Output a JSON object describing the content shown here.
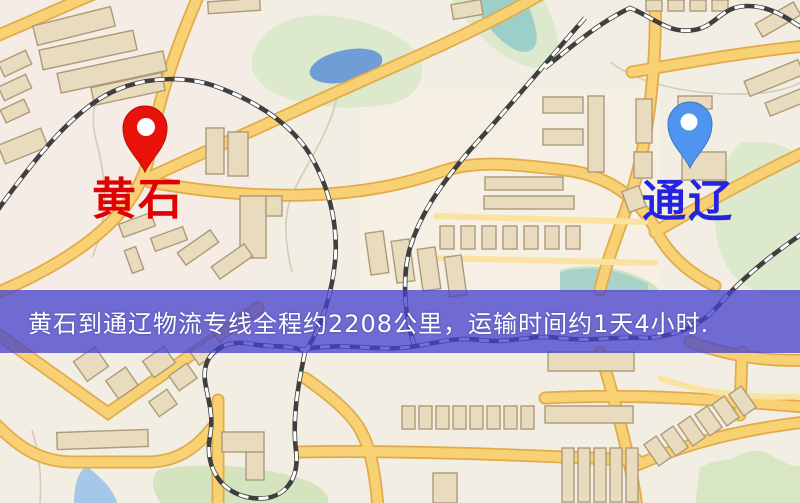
{
  "banner": {
    "text": "黄石到通辽物流专线全程约2208公里，运输时间约1天4小时.",
    "background_color": "#4642cd",
    "text_color": "#ffffff"
  },
  "route": {
    "origin": "黄石",
    "destination": "通辽",
    "distance_km": "2208",
    "duration": "1天4小时"
  },
  "markers": {
    "origin": {
      "label": "黄石",
      "pin_color": "#e81209",
      "label_color": "#e00202"
    },
    "destination": {
      "label": "通辽",
      "pin_color": "#4f95ef",
      "label_color": "#2424de"
    }
  },
  "map_colors": {
    "background": "#f3eee3",
    "road_fill": "#f7d173",
    "road_casing": "#e2ab4a",
    "building": "#e9dcbe",
    "green_area": "#dce9cc",
    "water_pond": "#6f9ed6",
    "water_stream": "#9ccfc8",
    "railway": "#3f3f3f"
  }
}
